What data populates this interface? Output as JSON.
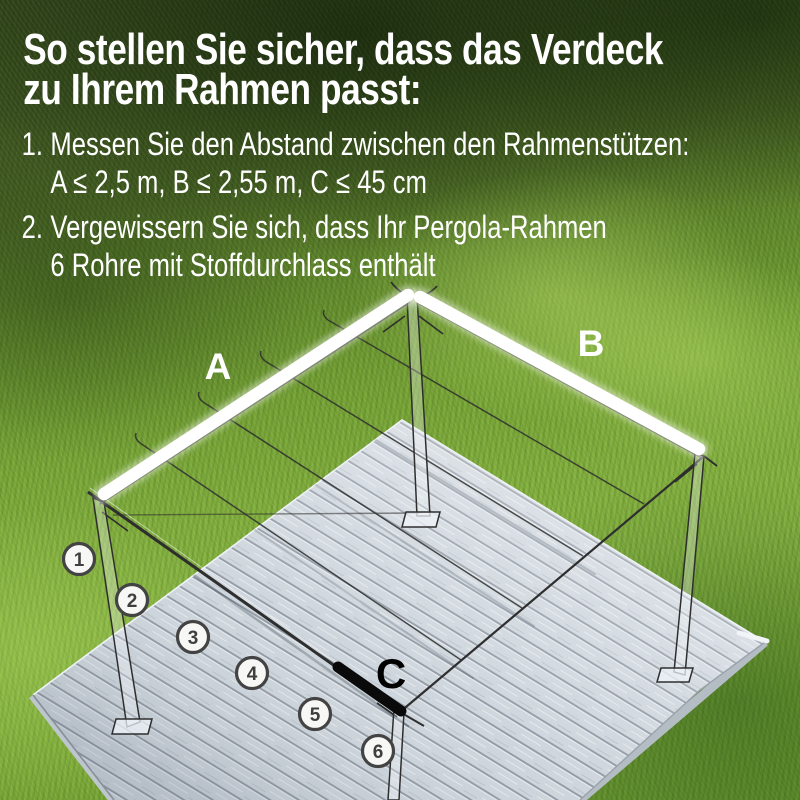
{
  "instructions": {
    "title_line1": "So stellen Sie sicher, dass das Verdeck",
    "title_line2": "zu Ihrem Rahmen passt:",
    "steps": [
      {
        "marker": "1.",
        "line1": "Messen Sie den Abstand zwischen den Rahmenstützen:",
        "line2": "A ≤ 2,5 m, B ≤ 2,55 m, C ≤ 45 cm"
      },
      {
        "marker": "2.",
        "line1": "Vergewissern Sie sich, dass Ihr Pergola-Rahmen",
        "line2": "6 Rohre mit Stoffdurchlass enthält"
      }
    ]
  },
  "diagram": {
    "labels": {
      "beam_left": "A",
      "beam_right": "B",
      "spacing": "C"
    },
    "tube_markers": [
      "1",
      "2",
      "3",
      "4",
      "5",
      "6"
    ],
    "colors": {
      "highlight_beam": "#ffffff",
      "measure_bar": "#0a0a0a",
      "frame_line": "#2e2e2e",
      "deck_plank": "#ccd4db",
      "grass_dark": "#33461c",
      "grass_light": "#86b244",
      "text": "#ffffff",
      "marker_ring": "#434343"
    }
  }
}
